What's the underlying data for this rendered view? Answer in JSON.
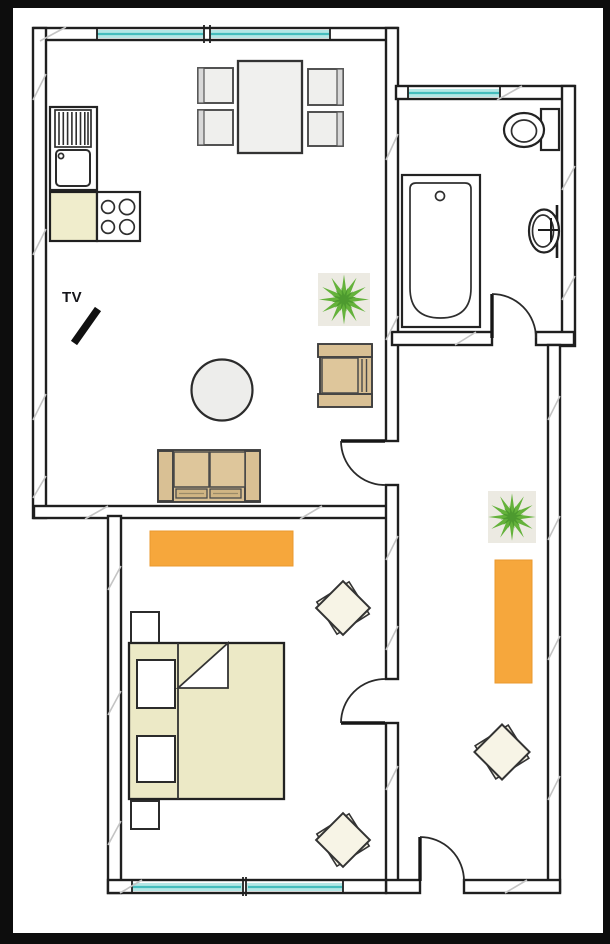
{
  "labels": {
    "tv": "TV"
  },
  "colors": {
    "frame_black": "#0d0d0d",
    "floor_white": "#ffffff",
    "wall_line": "#1f1f1f",
    "window_glass": "#b4e7e6",
    "window_line": "#45bdbd",
    "rug_orange": "#f6a73c",
    "sofa_tan": "#d9c094",
    "cushion_tan": "#dec69b",
    "cushion_dark_tan": "#d0b584",
    "bed_beige": "#ece9c6",
    "counter_beige": "#f0edcc",
    "plant_green": "#64b23b",
    "plant_green_dark": "#4d9a2f",
    "table_gray": "#ededeb",
    "pouf_cream": "#f7f4e6",
    "hatch_gray": "#c4c4c4"
  },
  "rooms": {
    "living_kitchen": {
      "items": [
        "kitchen-sink-unit",
        "stove",
        "counter",
        "dining-table",
        "dining-chairs",
        "tv",
        "round-table",
        "sofa",
        "armchair",
        "plant"
      ]
    },
    "bathroom": {
      "items": [
        "bathtub",
        "toilet",
        "washbasin"
      ]
    },
    "bedroom": {
      "items": [
        "double-bed",
        "pillows",
        "nightstands",
        "rug",
        "poufs"
      ]
    },
    "hallway": {
      "items": [
        "rug",
        "plant",
        "pouf"
      ]
    }
  }
}
